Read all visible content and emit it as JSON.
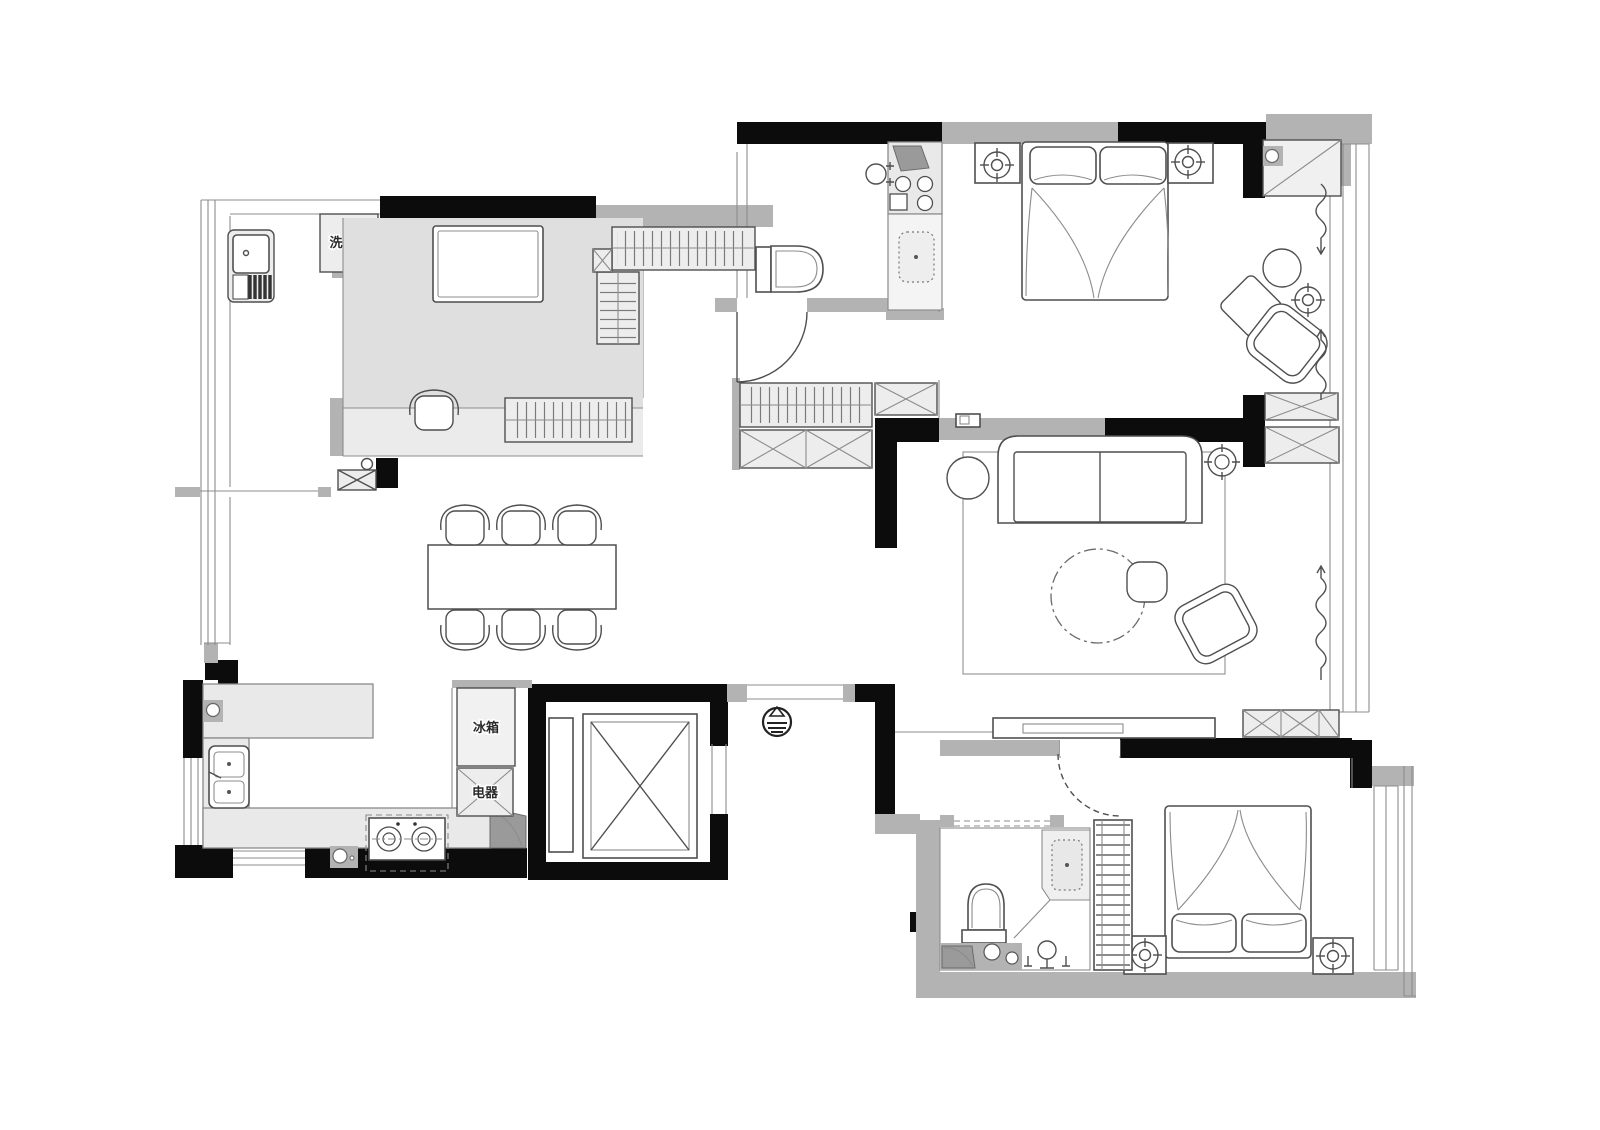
{
  "labels": {
    "washing_machine": "洗衣机",
    "fridge": "冰箱",
    "appliances": "电器"
  },
  "colors": {
    "background": "#ffffff",
    "wall_black": "#0c0c0c",
    "wall_gray": "#b3b3b3",
    "cabinet_fill": "#ededed",
    "counter_fill": "#e9e9e9",
    "floor_study": "#dfdfdf",
    "floor_platform": "#ebebeb",
    "dark_accent": "#9a9a9a",
    "line": "#4f4f4f"
  }
}
